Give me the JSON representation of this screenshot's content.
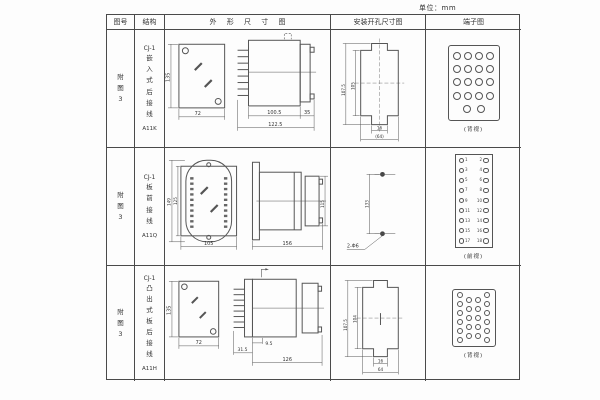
{
  "unit_label": "单位：mm",
  "header": {
    "figure_col": "图号",
    "structure_col": "结构",
    "outline_col": "外 形 尺 寸 图",
    "mounting_col": "安装开孔尺寸图",
    "terminal_col": "端子图"
  },
  "rows": [
    {
      "figure_no": "附图3",
      "structure": {
        "model": "CJ-1",
        "name": "嵌入式后接线",
        "code": "A11K"
      },
      "outline": {
        "front_height": "135",
        "front_width": "72",
        "body_len": "100.5",
        "total_len": "122.5",
        "flange_len": "35"
      },
      "mounting": {
        "outer_height": "107.5",
        "inner_height": "105",
        "slot_width": "16",
        "overall_width": "(64)"
      },
      "terminal": {
        "caption": "(背视)"
      }
    },
    {
      "figure_no": "附图3",
      "structure": {
        "model": "CJ-1",
        "name": "板前接线",
        "code": "A11Q"
      },
      "outline": {
        "oval_height": "149",
        "case_height": "125",
        "front_width": "105",
        "side_len": "156",
        "side_height": "115"
      },
      "mounting": {
        "hole_spacing": "133",
        "hole_spec": "2-Φ6"
      },
      "terminal": {
        "caption": "(前视)",
        "left_numbers": [
          "1",
          "3",
          "5",
          "7",
          "9",
          "11",
          "13",
          "15",
          "17"
        ],
        "right_numbers": [
          "2",
          "4",
          "6",
          "8",
          "10",
          "12",
          "14",
          "16",
          "18"
        ]
      }
    },
    {
      "figure_no": "附图3",
      "structure": {
        "model": "CJ-1",
        "name": "凸出式板后接线",
        "code": "A11H"
      },
      "outline": {
        "front_height": "135",
        "front_width": "72",
        "pin_len": "31.5",
        "offset": "9.5",
        "body_len": "126"
      },
      "mounting": {
        "outer_height": "107.5",
        "inner_height": "104",
        "slot_width": "16",
        "overall_width": "64"
      },
      "terminal": {
        "caption": "(背视)"
      }
    }
  ]
}
